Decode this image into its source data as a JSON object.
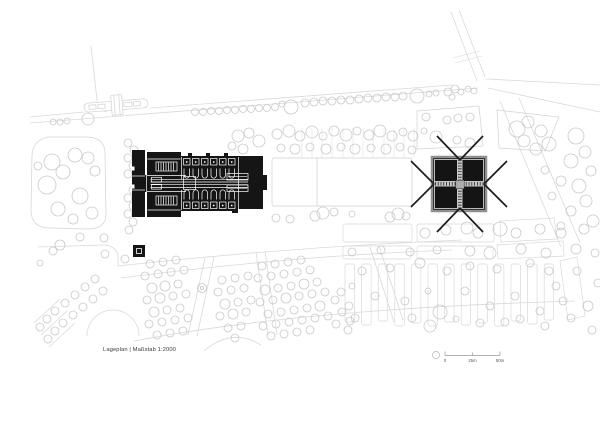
{
  "title": {
    "label": "Lageplan | Maßstab 1:2000"
  },
  "scalebar": {
    "zero": "0",
    "mid": "25m",
    "end": "50m"
  },
  "colors": {
    "background": "#ffffff",
    "linework": "#d9d9d9",
    "trees": "#c9c9c9",
    "buildings": "#151515",
    "church_frame": "#8f8f8f",
    "caption_text": "#3c3c3c"
  }
}
